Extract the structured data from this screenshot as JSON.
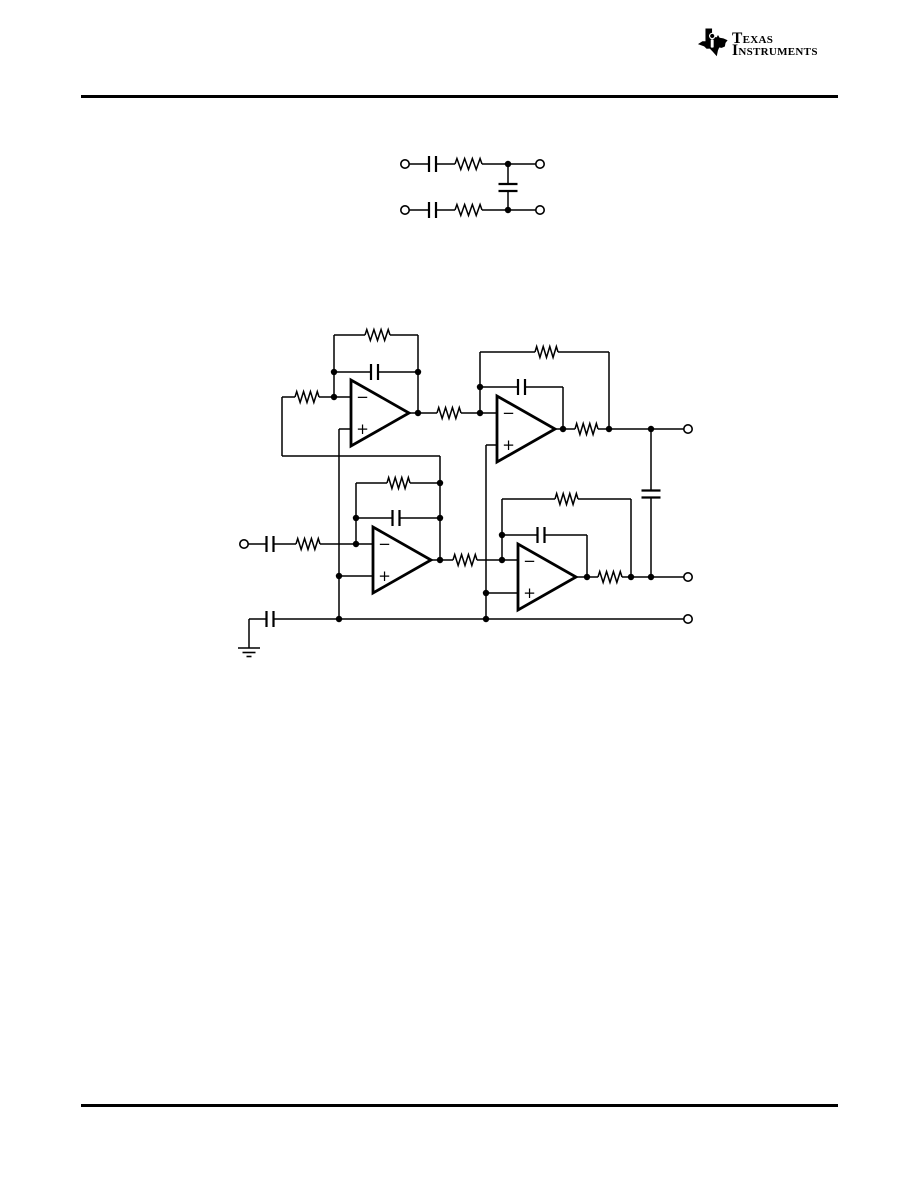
{
  "page": {
    "width": 918,
    "height": 1188,
    "bg": "#ffffff",
    "ink": "#000000"
  },
  "header": {
    "logo": {
      "icon": "texas-state-icon",
      "line1": "Texas",
      "line2": "Instruments"
    }
  },
  "symbols": {
    "opamp_minus": "−",
    "opamp_plus": "+"
  },
  "figures": [
    {
      "name": "figure-differential-rc-network",
      "wires": [
        [
          409,
          164,
          429,
          164
        ],
        [
          436,
          164,
          455,
          164
        ],
        [
          482,
          164,
          536,
          164
        ],
        [
          409,
          210,
          429,
          210
        ],
        [
          436,
          210,
          455,
          210
        ],
        [
          482,
          210,
          536,
          210
        ],
        [
          508,
          164,
          508,
          184
        ],
        [
          508,
          191,
          508,
          210
        ]
      ],
      "resistors": [
        {
          "x1": 455,
          "x2": 482,
          "y": 164
        },
        {
          "x1": 455,
          "x2": 482,
          "y": 210
        }
      ],
      "capacitors": [
        {
          "x": 432.5,
          "y": 164,
          "o": "h"
        },
        {
          "x": 432.5,
          "y": 210,
          "o": "h"
        },
        {
          "x": 508,
          "y": 187.5,
          "o": "v"
        }
      ],
      "opamps": [],
      "dots": [
        [
          508,
          164
        ],
        [
          508,
          210
        ]
      ],
      "terminals": [
        [
          405,
          164
        ],
        [
          540,
          164
        ],
        [
          405,
          210
        ],
        [
          540,
          210
        ]
      ],
      "grounds": []
    },
    {
      "name": "figure-differential-biquad-filter",
      "wires": [
        [
          334,
          335,
          365,
          335
        ],
        [
          390,
          335,
          418,
          335
        ],
        [
          334,
          335,
          334,
          397
        ],
        [
          334,
          372,
          371,
          372
        ],
        [
          378,
          372,
          418,
          372
        ],
        [
          418,
          335,
          418,
          413
        ],
        [
          282,
          397,
          295,
          397
        ],
        [
          319,
          397,
          351,
          397
        ],
        [
          282,
          397,
          282,
          456
        ],
        [
          282,
          456,
          440,
          456
        ],
        [
          440,
          456,
          440,
          560
        ],
        [
          351,
          429,
          339,
          429
        ],
        [
          339,
          429,
          339,
          619
        ],
        [
          409,
          413,
          437,
          413
        ],
        [
          461,
          413,
          497,
          413
        ],
        [
          480,
          352,
          535,
          352
        ],
        [
          558,
          352,
          609,
          352
        ],
        [
          480,
          352,
          480,
          413
        ],
        [
          480,
          387,
          518,
          387
        ],
        [
          525,
          387,
          563,
          387
        ],
        [
          563,
          387,
          563,
          429
        ],
        [
          609,
          352,
          609,
          429
        ],
        [
          555,
          429,
          575,
          429
        ],
        [
          598,
          429,
          684,
          429
        ],
        [
          497,
          445,
          486,
          445
        ],
        [
          486,
          445,
          486,
          619
        ],
        [
          356,
          483,
          387,
          483
        ],
        [
          410,
          483,
          440,
          483
        ],
        [
          356,
          483,
          356,
          544
        ],
        [
          356,
          518,
          392.5,
          518
        ],
        [
          399.5,
          518,
          440,
          518
        ],
        [
          248,
          544,
          266.5,
          544
        ],
        [
          273.5,
          544,
          296,
          544
        ],
        [
          320,
          544,
          373,
          544
        ],
        [
          373,
          576,
          339,
          576
        ],
        [
          431,
          560,
          453,
          560
        ],
        [
          477,
          560,
          518,
          560
        ],
        [
          502,
          499,
          555,
          499
        ],
        [
          578,
          499,
          631,
          499
        ],
        [
          502,
          499,
          502,
          560
        ],
        [
          502,
          535,
          537.5,
          535
        ],
        [
          544.5,
          535,
          587,
          535
        ],
        [
          587,
          535,
          587,
          577
        ],
        [
          631,
          499,
          631,
          577
        ],
        [
          518,
          593,
          486,
          593
        ],
        [
          576,
          577,
          598,
          577
        ],
        [
          622,
          577,
          684,
          577
        ],
        [
          651,
          429,
          651,
          490
        ],
        [
          651,
          498,
          651,
          577
        ],
        [
          249,
          619,
          266.5,
          619
        ],
        [
          273.5,
          619,
          684,
          619
        ],
        [
          249,
          619,
          249,
          648
        ]
      ],
      "resistors": [
        {
          "x1": 365,
          "x2": 390,
          "y": 335
        },
        {
          "x1": 295,
          "x2": 319,
          "y": 397
        },
        {
          "x1": 437,
          "x2": 461,
          "y": 413
        },
        {
          "x1": 535,
          "x2": 558,
          "y": 352
        },
        {
          "x1": 575,
          "x2": 598,
          "y": 429
        },
        {
          "x1": 387,
          "x2": 410,
          "y": 483
        },
        {
          "x1": 296,
          "x2": 320,
          "y": 544
        },
        {
          "x1": 453,
          "x2": 477,
          "y": 560
        },
        {
          "x1": 555,
          "x2": 578,
          "y": 499
        },
        {
          "x1": 598,
          "x2": 622,
          "y": 577
        }
      ],
      "capacitors": [
        {
          "x": 374.5,
          "y": 372,
          "o": "h"
        },
        {
          "x": 521.5,
          "y": 387,
          "o": "h"
        },
        {
          "x": 396,
          "y": 518,
          "o": "h"
        },
        {
          "x": 541,
          "y": 535,
          "o": "h"
        },
        {
          "x": 270,
          "y": 544,
          "o": "h"
        },
        {
          "x": 270,
          "y": 619,
          "o": "h"
        },
        {
          "x": 651,
          "y": 494,
          "o": "v"
        }
      ],
      "opamps": [
        {
          "x": 351,
          "y": 413
        },
        {
          "x": 497,
          "y": 429
        },
        {
          "x": 373,
          "y": 560
        },
        {
          "x": 518,
          "y": 577
        }
      ],
      "dots": [
        [
          334,
          372
        ],
        [
          334,
          397
        ],
        [
          418,
          372
        ],
        [
          418,
          413
        ],
        [
          480,
          387
        ],
        [
          480,
          413
        ],
        [
          563,
          429
        ],
        [
          609,
          429
        ],
        [
          651,
          429
        ],
        [
          356,
          518
        ],
        [
          356,
          544
        ],
        [
          440,
          483
        ],
        [
          440,
          518
        ],
        [
          440,
          560
        ],
        [
          502,
          535
        ],
        [
          502,
          560
        ],
        [
          587,
          577
        ],
        [
          631,
          577
        ],
        [
          651,
          577
        ],
        [
          339,
          576
        ],
        [
          339,
          619
        ],
        [
          486,
          593
        ],
        [
          486,
          619
        ]
      ],
      "terminals": [
        [
          244,
          544
        ],
        [
          688,
          429
        ],
        [
          688,
          577
        ],
        [
          688,
          619
        ]
      ],
      "grounds": [
        {
          "x": 249,
          "y": 648
        }
      ]
    }
  ]
}
